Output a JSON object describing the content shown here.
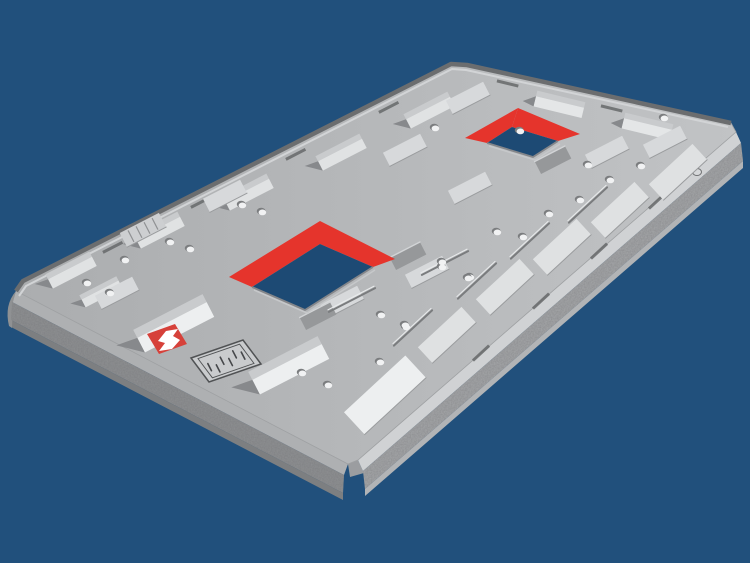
{
  "meta": {
    "title": "3D rendering of a grey steel wear plate with two red-rimmed rectangular openings, rows of wedge-shaped wear bars and bolt holes, shown on a dark blue background",
    "canvas_width": 750,
    "canvas_height": 563
  },
  "logo": {
    "badge_color": "#d6413a",
    "glyph": "stylized-S-mark",
    "glyph_color": "#ffffff",
    "spec_plate_text": "illegible embossed text"
  },
  "colors": {
    "background": "#21507c",
    "hole": "#1d4a74",
    "plate_light": "#c1c3c5",
    "plate_dark": "#abadaf",
    "red": "#e5342c",
    "bright": "#edeff0",
    "feature_top": "#c9cbcd",
    "shade": "#87898c",
    "dark_wedge": "#96989a",
    "notch": "#66686a",
    "rim_dark": "#6b6d6f",
    "rim_light": "#d2d4d6",
    "chamfer_r": "#d0d2d4",
    "face_r": "#a6a8aa",
    "bottom_r": "#b2b4b6",
    "chamfer_l": "#aeb0b2",
    "face_l": "#8f9193",
    "bottom_l": "#7d7f81",
    "corner": "#9b9da0",
    "dot": "#f1f2f3",
    "dot_shadow": "#7b7d7f",
    "rib_dark": "#7a7c7e",
    "rib_light": "#e9ebec",
    "pad": "#dfe1e2",
    "hatch_fill": "#cdcfd1",
    "hatch_line": "#8f9193",
    "pad_edge": "#9a9c9e",
    "lip_dark": "#84868a",
    "lip_light": "#c6c8ca",
    "spec_fill": "#c9cbcd",
    "spec_stroke": "#505254",
    "spec_text": "#45474a"
  },
  "scene": {
    "plate_top": [
      [
        16,
        291
      ],
      [
        23,
        281
      ],
      [
        451,
        64
      ],
      [
        467,
        65
      ],
      [
        731,
        123
      ],
      [
        736,
        132
      ],
      [
        358,
        460
      ],
      [
        348,
        464
      ]
    ],
    "right_edge": [
      [
        736,
        132
      ],
      [
        358,
        460
      ]
    ],
    "left_edge": [
      [
        348,
        464
      ],
      [
        16,
        291
      ]
    ],
    "far_rim": [
      [
        16,
        291
      ],
      [
        23,
        281
      ],
      [
        451,
        64
      ],
      [
        467,
        65
      ],
      [
        731,
        123
      ]
    ],
    "far_rim_inner": [
      [
        19,
        296
      ],
      [
        26,
        286
      ],
      [
        452,
        69
      ],
      [
        466,
        70
      ],
      [
        728,
        127
      ]
    ],
    "openings": [
      {
        "red_left": [
          [
            229,
            277
          ],
          [
            320,
            221
          ],
          [
            320,
            244
          ],
          [
            252,
            287
          ]
        ],
        "red_right": [
          [
            320,
            221
          ],
          [
            395,
            259
          ],
          [
            373,
            267
          ],
          [
            320,
            244
          ]
        ],
        "hole": [
          [
            320,
            244
          ],
          [
            373,
            267
          ],
          [
            305,
            310
          ],
          [
            252,
            287
          ]
        ]
      },
      {
        "red_left": [
          [
            465,
            138
          ],
          [
            518,
            108
          ],
          [
            512,
            127
          ],
          [
            487,
            143
          ]
        ],
        "red_right": [
          [
            518,
            108
          ],
          [
            580,
            134
          ],
          [
            558,
            141
          ],
          [
            512,
            127
          ]
        ],
        "hole": [
          [
            512,
            127
          ],
          [
            558,
            141
          ],
          [
            533,
            157
          ],
          [
            487,
            143
          ]
        ]
      }
    ],
    "far_ramps": [
      [
        70,
        268
      ],
      [
        158,
        228
      ],
      [
        247,
        190
      ],
      [
        340,
        150
      ],
      [
        428,
        108
      ]
    ],
    "end_ramps": [
      [
        560,
        102
      ],
      [
        648,
        124
      ]
    ],
    "near_ramps": [
      [
        172,
        320
      ],
      [
        287,
        362
      ]
    ],
    "small_ramps": [
      [
        100,
        290
      ]
    ],
    "edge_pads": [
      [
        447,
        335
      ],
      [
        505,
        287
      ],
      [
        562,
        247
      ],
      [
        620,
        210
      ],
      [
        678,
        172
      ]
    ],
    "big_edge_pad": [
      385,
      395
    ],
    "mid_pads": [
      [
        225,
        196
      ],
      [
        405,
        150
      ],
      [
        470,
        188
      ],
      [
        342,
        302
      ],
      [
        607,
        152
      ],
      [
        665,
        142
      ],
      [
        468,
        98
      ],
      [
        117,
        293
      ],
      [
        427,
        272
      ]
    ],
    "dark_wedges": [
      [
        408,
        256
      ],
      [
        318,
        316
      ],
      [
        553,
        160
      ]
    ],
    "hatch_pads": [
      [
        143,
        230
      ]
    ],
    "notches_a": [
      [
        112,
        246
      ],
      [
        200,
        201
      ],
      [
        295,
        153
      ],
      [
        388,
        106
      ]
    ],
    "notches_c": [
      [
        508,
        82
      ],
      [
        612,
        107
      ]
    ],
    "notches_b": [
      [
        598,
        250
      ],
      [
        540,
        300
      ],
      [
        480,
        352
      ],
      [
        656,
        200
      ]
    ],
    "ribs_a": [
      [
        445,
        263
      ],
      [
        352,
        300
      ]
    ],
    "ribs_b": [
      [
        477,
        281
      ],
      [
        413,
        328
      ],
      [
        530,
        241
      ],
      [
        588,
        205
      ]
    ],
    "dots": [
      [
        125,
        260
      ],
      [
        170,
        242
      ],
      [
        190,
        249
      ],
      [
        242,
        205
      ],
      [
        262,
        212
      ],
      [
        87,
        283
      ],
      [
        110,
        293
      ],
      [
        381,
        315
      ],
      [
        406,
        327
      ],
      [
        442,
        267
      ],
      [
        470,
        277
      ],
      [
        497,
        232
      ],
      [
        442,
        262
      ],
      [
        523,
        237
      ],
      [
        468,
        278
      ],
      [
        405,
        325
      ],
      [
        302,
        373
      ],
      [
        328,
        385
      ],
      [
        380,
        362
      ],
      [
        549,
        214
      ],
      [
        588,
        165
      ],
      [
        641,
        166
      ],
      [
        580,
        200
      ],
      [
        435,
        128
      ],
      [
        520,
        131
      ],
      [
        610,
        180
      ],
      [
        664,
        118
      ]
    ],
    "side_hole": [
      697,
      172
    ],
    "logo_quad": [
      [
        147,
        334
      ],
      [
        175,
        324
      ],
      [
        187,
        344
      ],
      [
        159,
        354
      ]
    ],
    "logo_glyph": "M158,341 L166,331 L178,329 L173,336 L180,340 L172,349 L159,351 L165,343 Z",
    "spec_quad": [
      [
        191,
        358
      ],
      [
        243,
        340
      ],
      [
        261,
        364
      ],
      [
        209,
        382
      ]
    ],
    "spec_center": [
      226,
      361
    ]
  }
}
